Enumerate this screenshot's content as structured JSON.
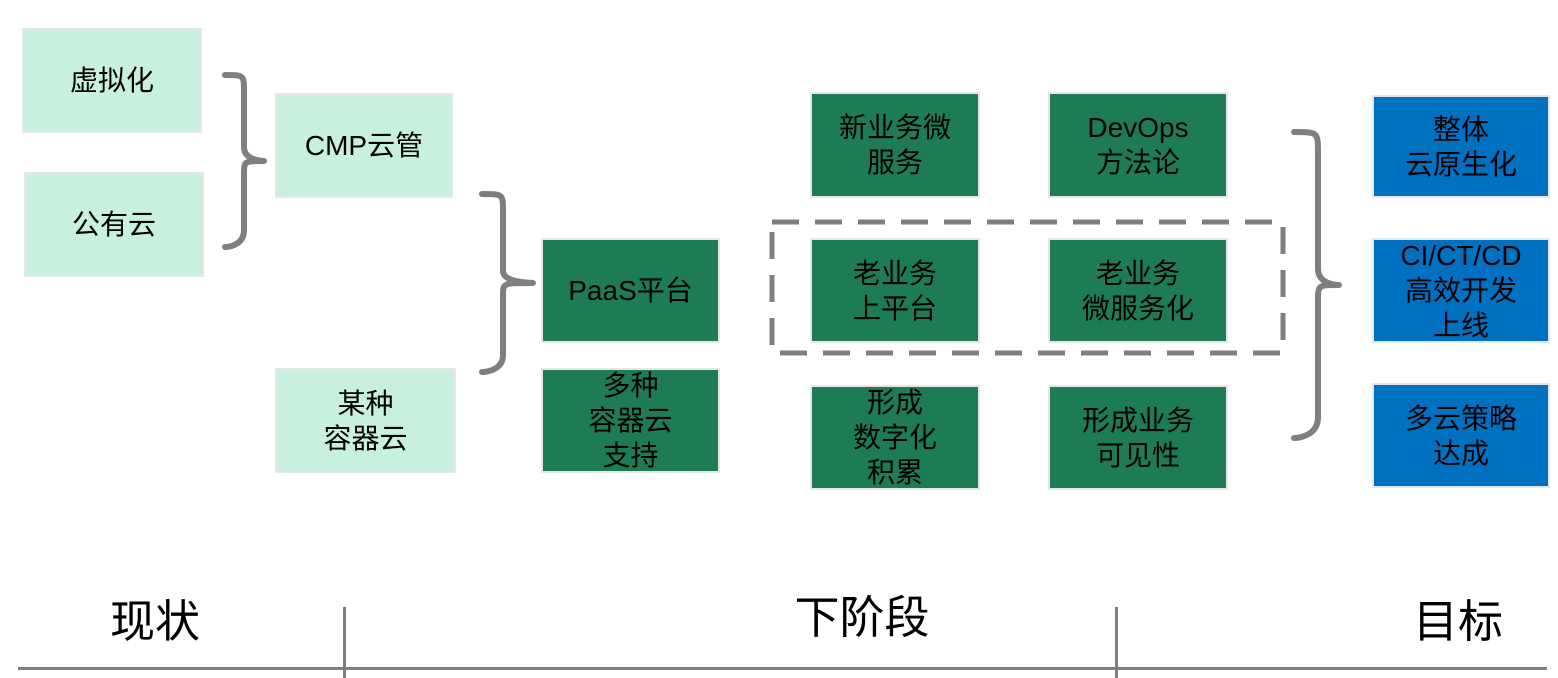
{
  "colors": {
    "current_state_fill": "#c7f0df",
    "next_stage_fill": "#1e7c55",
    "goal_fill": "#0070c0",
    "connector_gray": "#7f7f7f",
    "text_color": "#000000"
  },
  "boxes": {
    "virtualization": "虚拟化",
    "public_cloud": "公有云",
    "cmp_cloud_mgmt": "CMP云管",
    "some_container_cloud": "某种\n容器云",
    "paas_platform": "PaaS平台",
    "multi_container_support": "多种\n容器云\n支持",
    "new_biz_microservice": "新业务微\n服务",
    "devops_methodology": "DevOps\n方法论",
    "legacy_on_platform": "老业务\n上平台",
    "legacy_microservice": "老业务\n微服务化",
    "digital_accumulation": "形成\n数字化\n积累",
    "biz_visibility": "形成业务\n可见性",
    "overall_cloud_native": "整体\n云原生化",
    "ci_ct_cd": "CI/CT/CD\n高效开发\n上线",
    "multicloud_strategy": "多云策略\n达成"
  },
  "footer": {
    "current_label": "现状",
    "next_label": "下阶段",
    "goal_label": "目标"
  }
}
